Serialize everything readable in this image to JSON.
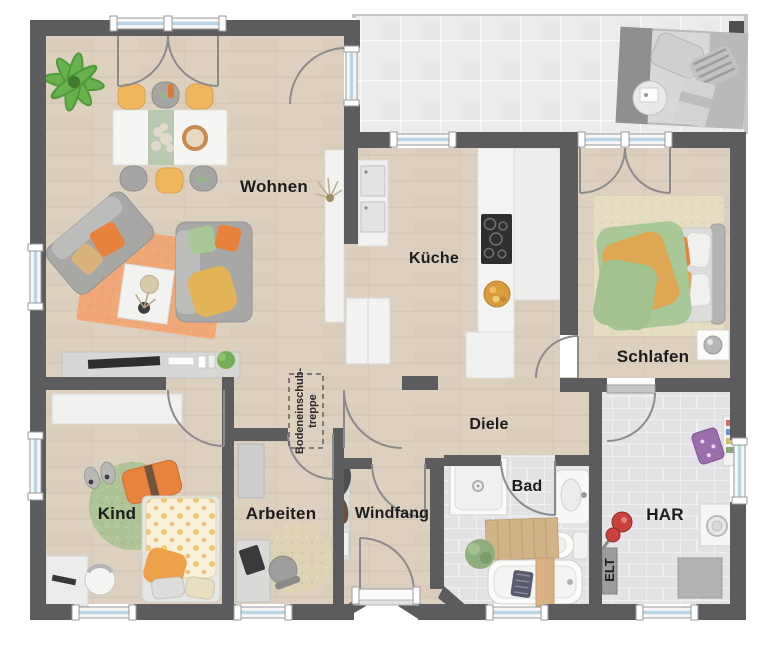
{
  "page": {
    "type": "floor-plan",
    "background": "#ffffff"
  },
  "rooms": {
    "wohnen": {
      "label": "Wohnen"
    },
    "kueche": {
      "label": "Küche"
    },
    "schlafen": {
      "label": "Schlafen"
    },
    "diele": {
      "label": "Diele"
    },
    "kind": {
      "label": "Kind"
    },
    "arbeiten": {
      "label": "Arbeiten"
    },
    "windfang": {
      "label": "Windfang"
    },
    "bad": {
      "label": "Bad"
    },
    "har": {
      "label": "HAR"
    },
    "elt": {
      "label": "ELT"
    }
  },
  "annotations": {
    "attic_stair": {
      "line1": "Bodeneinschub-",
      "line2": "treppe"
    }
  },
  "colors": {
    "wall": "#5c5c5e",
    "wood_floor": "#ddd0bf",
    "terrace_tile": "#ececec",
    "bath_tile": "#e3e3e5",
    "window_glass": "#b9d6e6",
    "window_frame": "#f7f7f7",
    "door_arc": "#8b8b8b",
    "label_text": "#1c1c1c",
    "accent_orange": "#e8813b",
    "rug_orange": "#f0a877",
    "accent_green": "#a9c897",
    "accent_yellow": "#eeb75e",
    "rug_green": "#aec496",
    "rug_beige": "#e6dcc2",
    "furniture_white": "#f3f3f1",
    "furniture_gray": "#a8a8a6",
    "red_item": "#c43a36",
    "purple_item": "#9b6fae"
  }
}
